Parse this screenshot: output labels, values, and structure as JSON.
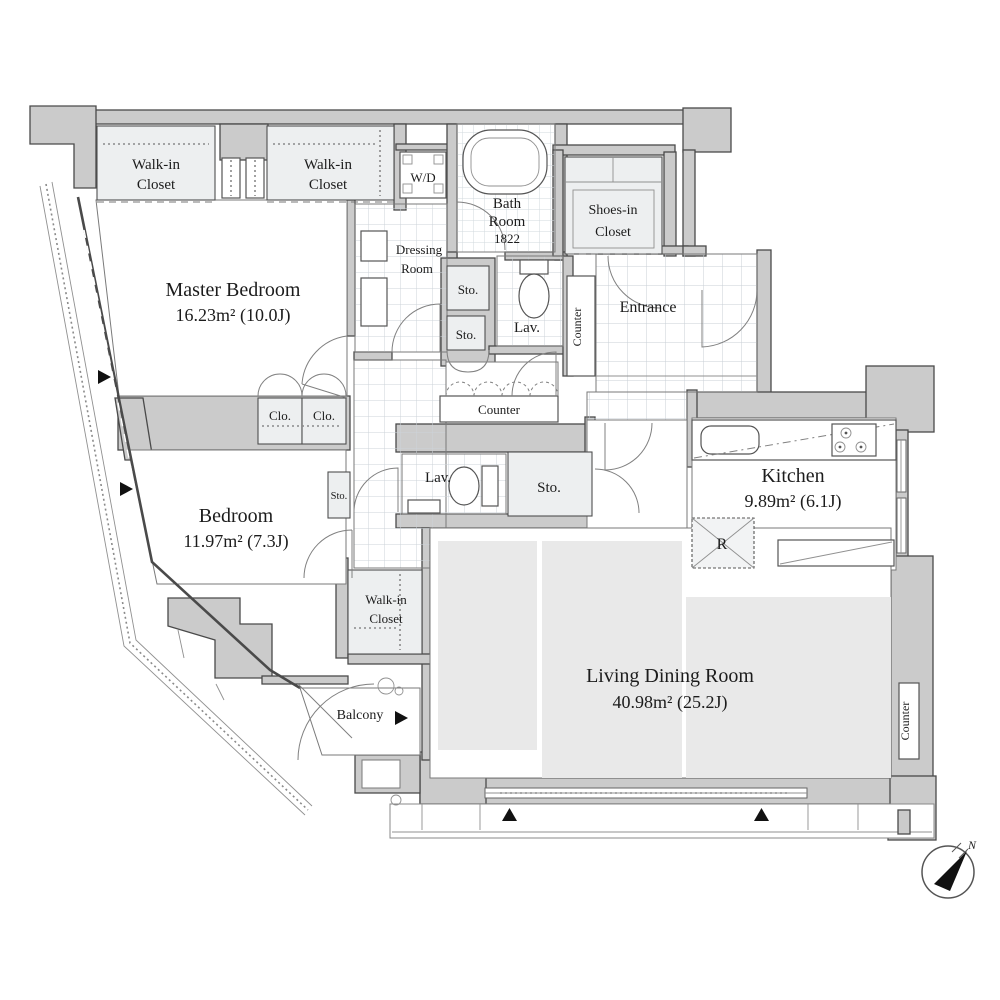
{
  "title": "Apartment floor plan",
  "colors": {
    "wall_fill": "#cbcbcb",
    "wall_stroke": "#4a4a4a",
    "closet_fill": "#edeff0",
    "shade_fill": "#e9e9e9",
    "text": "#1c1c1c",
    "marker": "#111111"
  },
  "rooms": {
    "master_bedroom": {
      "name": "Master Bedroom",
      "area": "16.23m²  (10.0J)"
    },
    "bedroom": {
      "name": "Bedroom",
      "area": "11.97m²  (7.3J)"
    },
    "living_dining": {
      "name": "Living Dining Room",
      "area": "40.98m²  (25.2J)"
    },
    "kitchen": {
      "name": "Kitchen",
      "area": "9.89m²  (6.1J)"
    },
    "bath": {
      "line1": "Bath",
      "line2": "Room",
      "size": "1822"
    },
    "entrance": {
      "name": "Entrance"
    },
    "dressing": {
      "line1": "Dressing",
      "line2": "Room"
    },
    "balcony": {
      "name": "Balcony"
    },
    "wic1": {
      "line1": "Walk-in",
      "line2": "Closet"
    },
    "wic2": {
      "line1": "Walk-in",
      "line2": "Closet"
    },
    "wic3": {
      "line1": "Walk-in",
      "line2": "Closet"
    },
    "shoes_closet": {
      "line1": "Shoes-in",
      "line2": "Closet"
    },
    "wd": {
      "label": "W/D"
    },
    "clo1": {
      "label": "Clo."
    },
    "clo2": {
      "label": "Clo."
    },
    "sto1": {
      "label": "Sto."
    },
    "sto2": {
      "label": "Sto."
    },
    "sto3": {
      "label": "Sto."
    },
    "sto4": {
      "label": "Sto."
    },
    "lav1": {
      "label": "Lav."
    },
    "lav2": {
      "label": "Lav."
    },
    "counter_entrance": {
      "label": "Counter"
    },
    "counter_hall": {
      "label": "Counter"
    },
    "counter_living": {
      "label": "Counter"
    },
    "refrigerator": {
      "label": "R"
    }
  },
  "compass": {
    "label": "N"
  }
}
